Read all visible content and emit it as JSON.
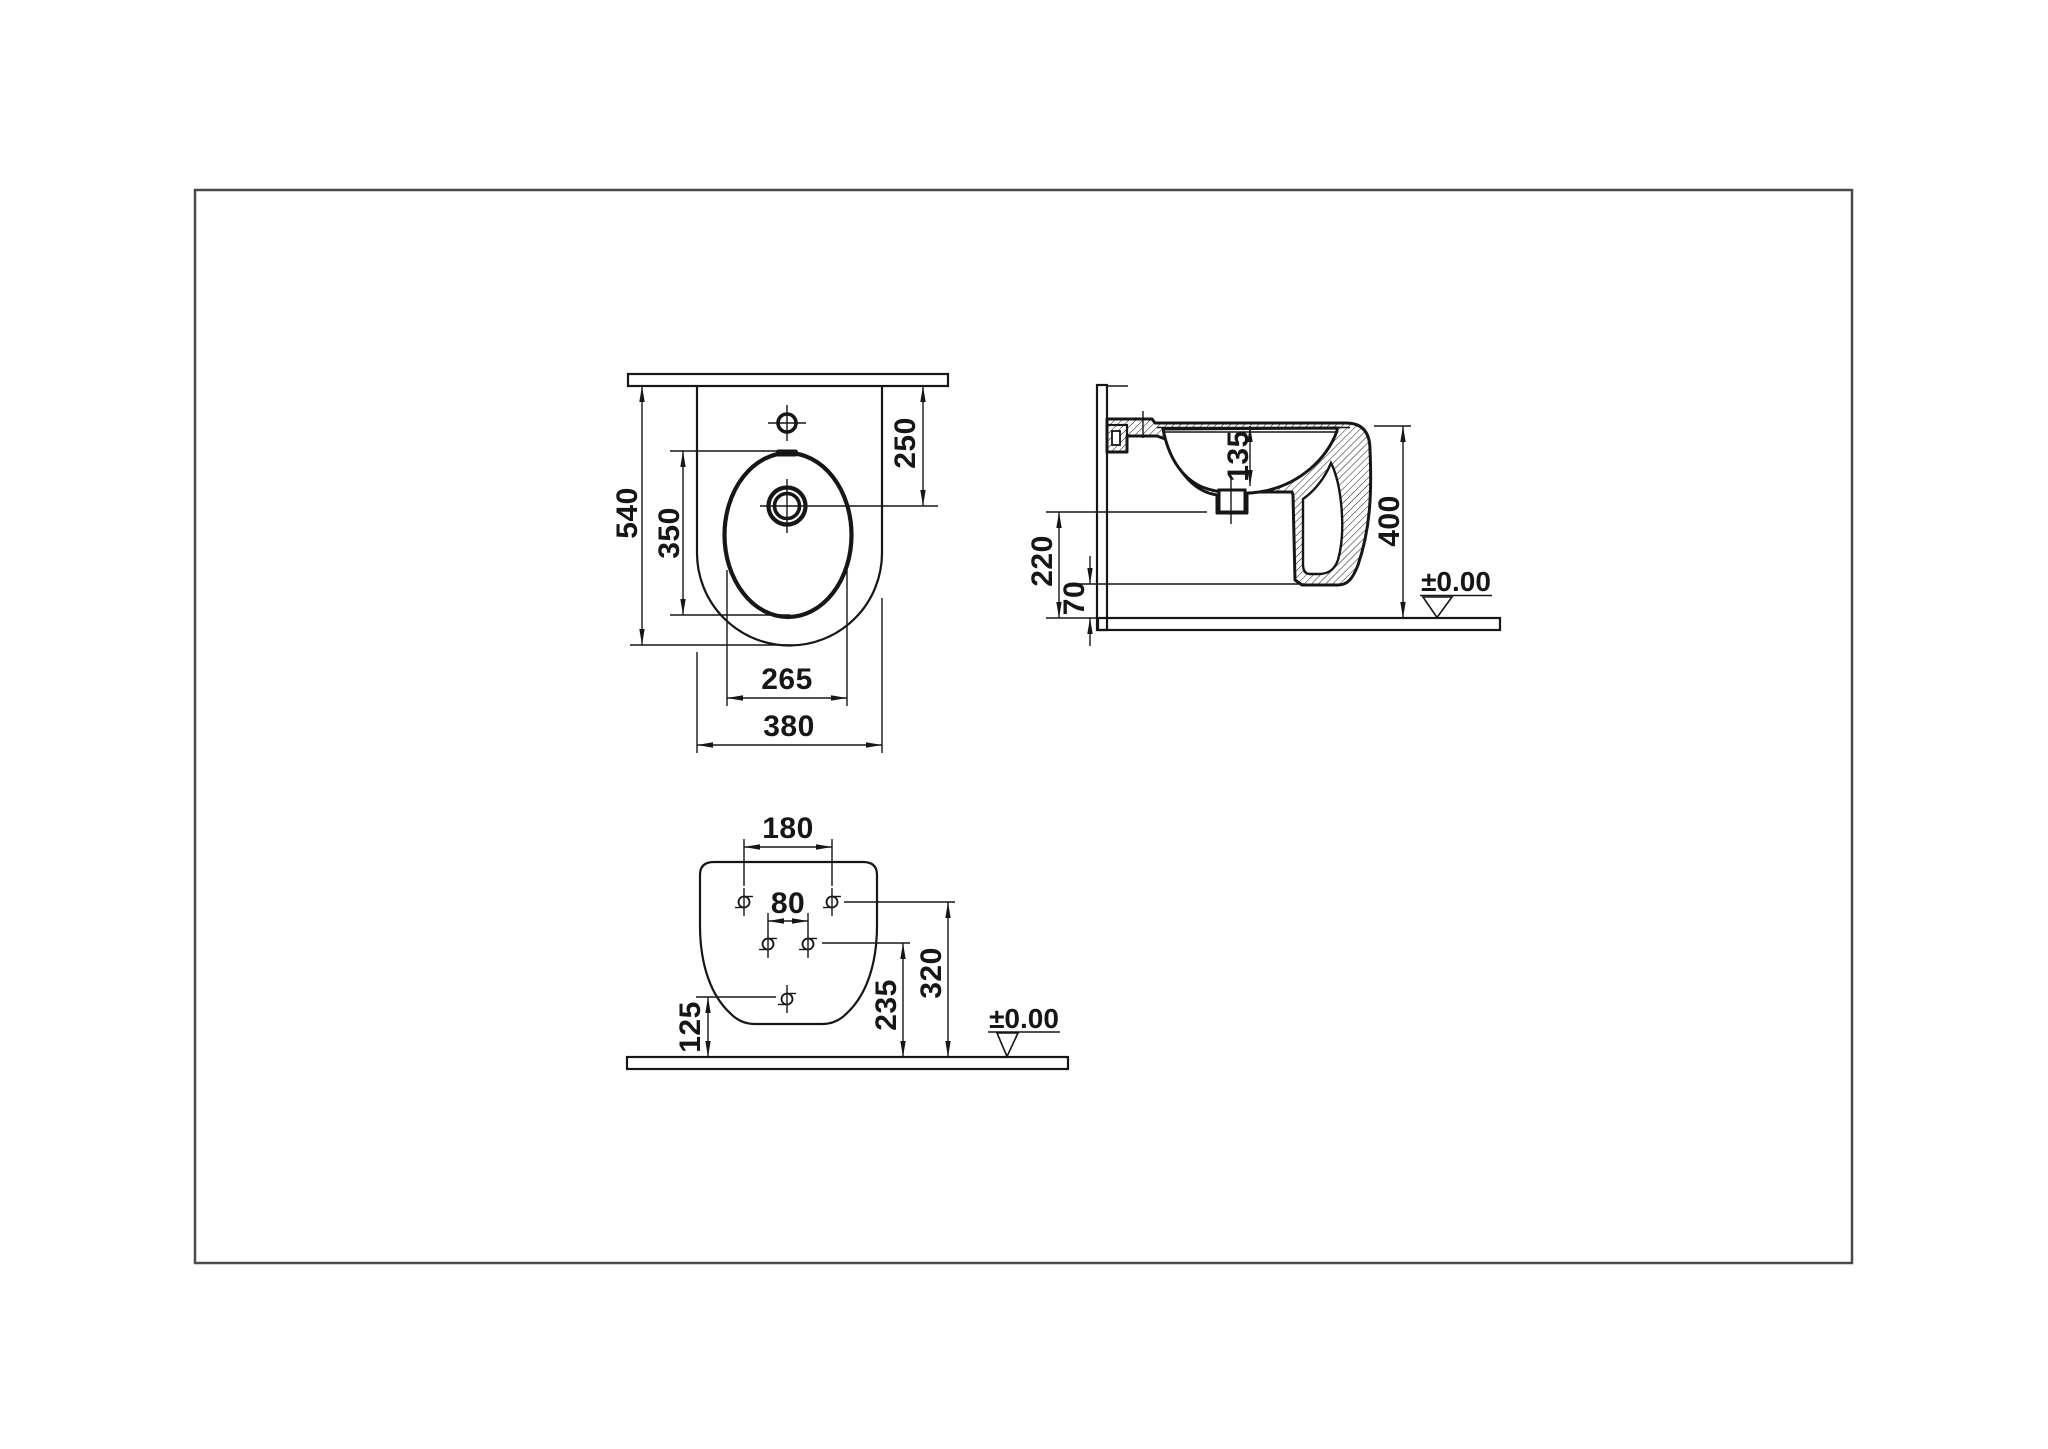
{
  "title": "Wall-hung bidet technical dimension drawing",
  "views": {
    "top": {
      "name": "Top view",
      "dims": {
        "overall_depth": "540",
        "bowl_length": "350",
        "drain_center_from_wall": "250",
        "bowl_width": "265",
        "overall_width": "380"
      }
    },
    "side": {
      "name": "Side section view",
      "dims": {
        "rim_to_bowl_bottom": "135",
        "rim_height": "400",
        "drain_height": "220",
        "underside_clearance": "70"
      },
      "floor_datum": "±0.00"
    },
    "back": {
      "name": "Back (wall fixing) view",
      "dims": {
        "upper_holes_spacing": "180",
        "middle_holes_spacing": "80",
        "upper_holes_height": "320",
        "middle_holes_height": "235",
        "lower_hole_height": "125"
      },
      "floor_datum": "±0.00"
    }
  },
  "colors": {
    "line": "#161616",
    "background": "#ffffff",
    "border": "#4a4a4a"
  }
}
